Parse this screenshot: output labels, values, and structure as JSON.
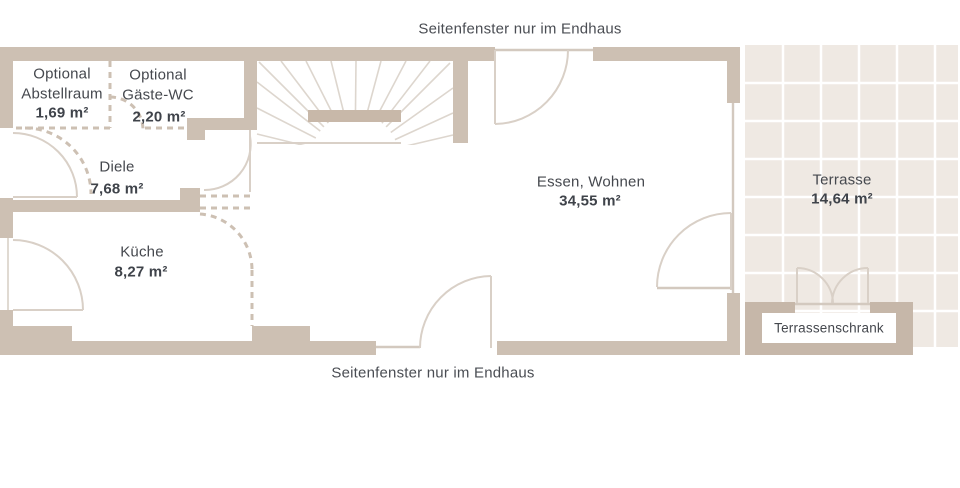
{
  "annotations": {
    "top": "Seitenfenster nur im Endhaus",
    "bottom": "Seitenfenster nur im Endhaus"
  },
  "rooms": {
    "abstellraum": {
      "prefix": "Optional",
      "name": "Abstellraum",
      "area": "1,69 m²"
    },
    "gaeste_wc": {
      "prefix": "Optional",
      "name": "Gäste-WC",
      "area": "2,20 m²"
    },
    "diele": {
      "name": "Diele",
      "area": "7,68 m²"
    },
    "kueche": {
      "name": "Küche",
      "area": "8,27 m²"
    },
    "essen_wohnen": {
      "name": "Essen, Wohnen",
      "area": "34,55 m²"
    },
    "terrasse": {
      "name": "Terrasse",
      "area": "14,64 m²"
    },
    "terrassenschrank": {
      "name": "Terrassenschrank"
    }
  },
  "colors": {
    "wall": "#cdc0b3",
    "wall_dark": "#c8b8a9",
    "schrank_wall": "#c6b7a9",
    "tile": "#efe9e3",
    "grout": "#ffffff",
    "swing_line": "#d9d0c7",
    "tread_line": "#ddd6ce",
    "text": "#45484e",
    "background": "#ffffff"
  }
}
